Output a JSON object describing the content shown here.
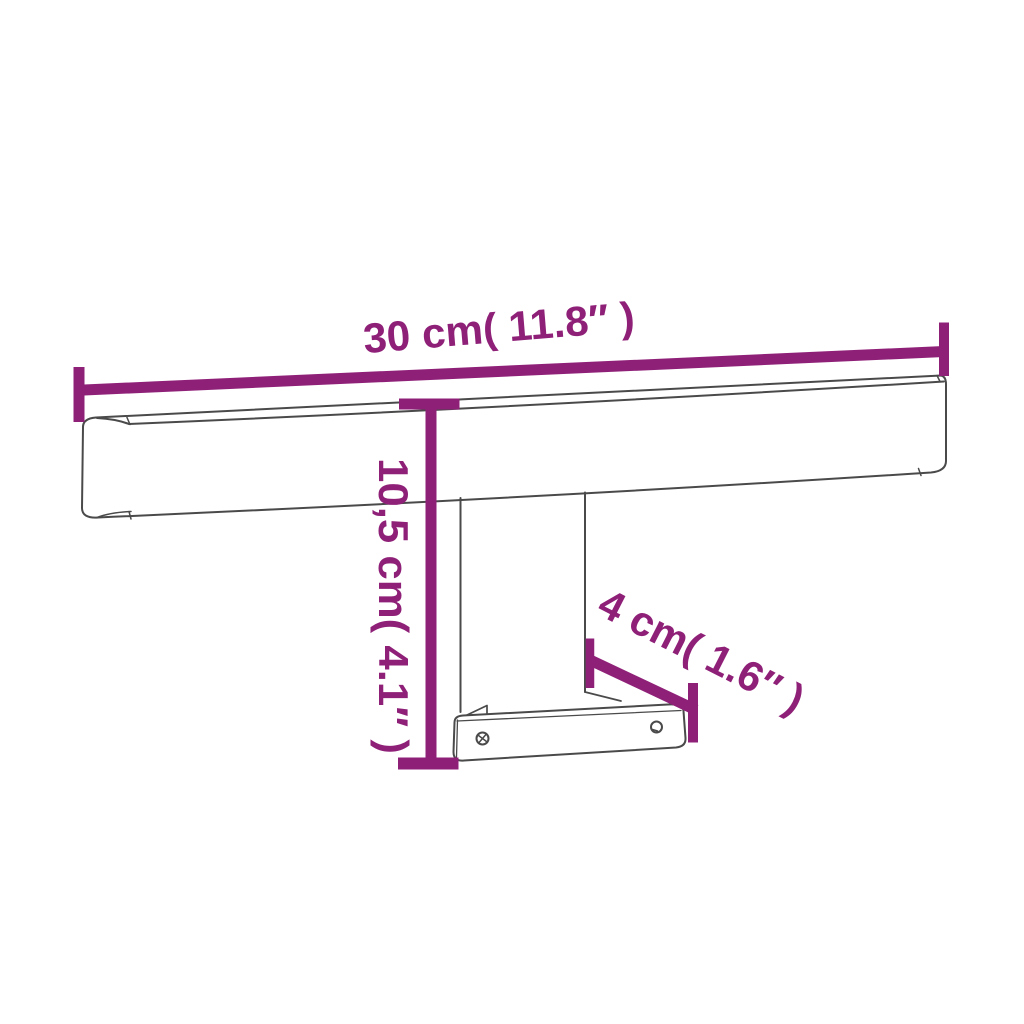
{
  "colors": {
    "accent": "#8F2078",
    "outline": "#4A4A4A",
    "background": "#FFFFFF"
  },
  "dimension_labels": {
    "width": "30 cm( 11.8″ )",
    "height": "10,5 cm( 4.1″ )",
    "depth": "4 cm( 1.6″ )"
  }
}
